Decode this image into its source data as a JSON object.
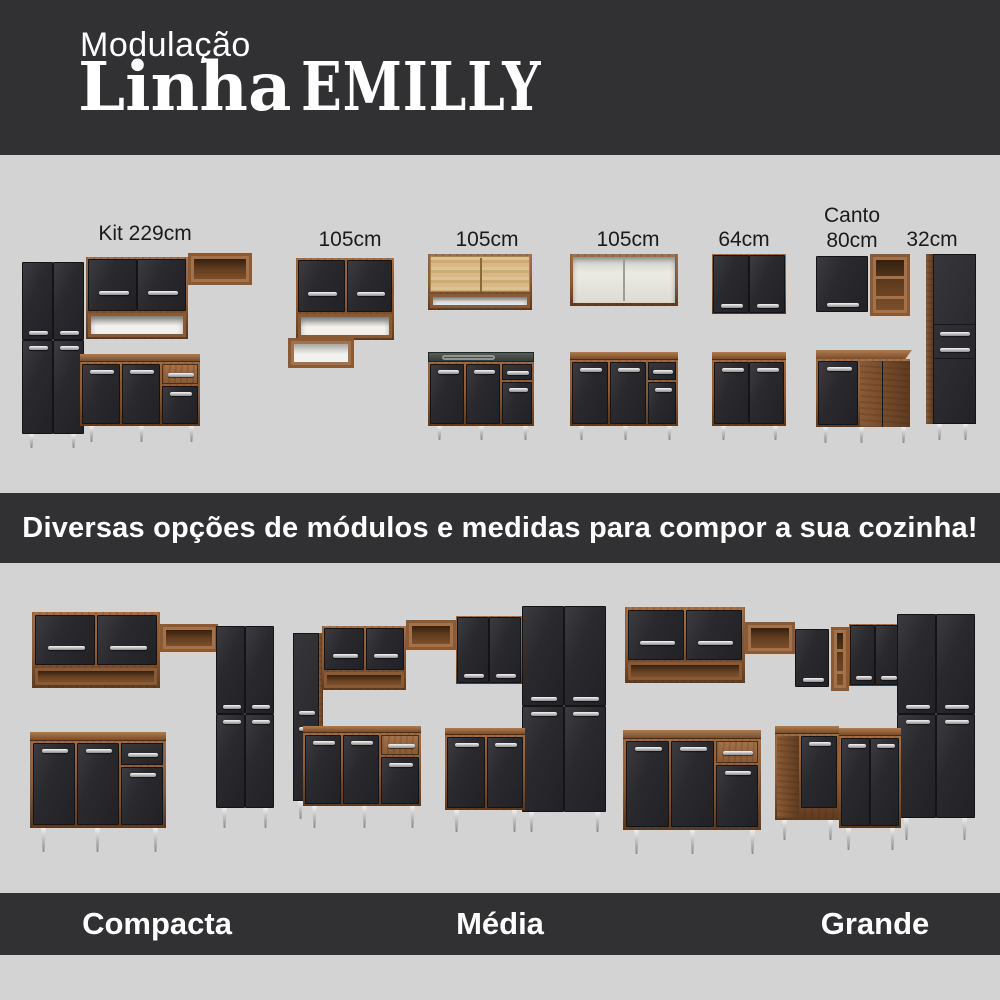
{
  "header": {
    "kicker": "Modulação",
    "title_line": "Linha",
    "title_brand": "EMILLY"
  },
  "modules_section": {
    "labels": {
      "kit": "Kit 229cm",
      "m105a": "105cm",
      "m105b": "105cm",
      "m105c": "105cm",
      "m64": "64cm",
      "canto_line1": "Canto",
      "canto_line2": "80cm",
      "m32": "32cm",
      "m60": "60cm"
    }
  },
  "banner": {
    "text": "Diversas opções de módulos e medidas para compor a sua cozinha!"
  },
  "kitchen_sizes": {
    "compacta": "Compacta",
    "media": "Média",
    "grande": "Grande"
  },
  "colors": {
    "band_dark": "#313133",
    "bg_light": "#d3d3d3",
    "wood": "#8a5a35",
    "wood_dark": "#5e3b20",
    "wood_light": "#a3714a",
    "door_black": "#28282b",
    "handle_silver": "#d9d9d9",
    "leg_silver": "#c6c6c6",
    "text_dark": "#1b1b1b",
    "text_light": "#ffffff"
  }
}
